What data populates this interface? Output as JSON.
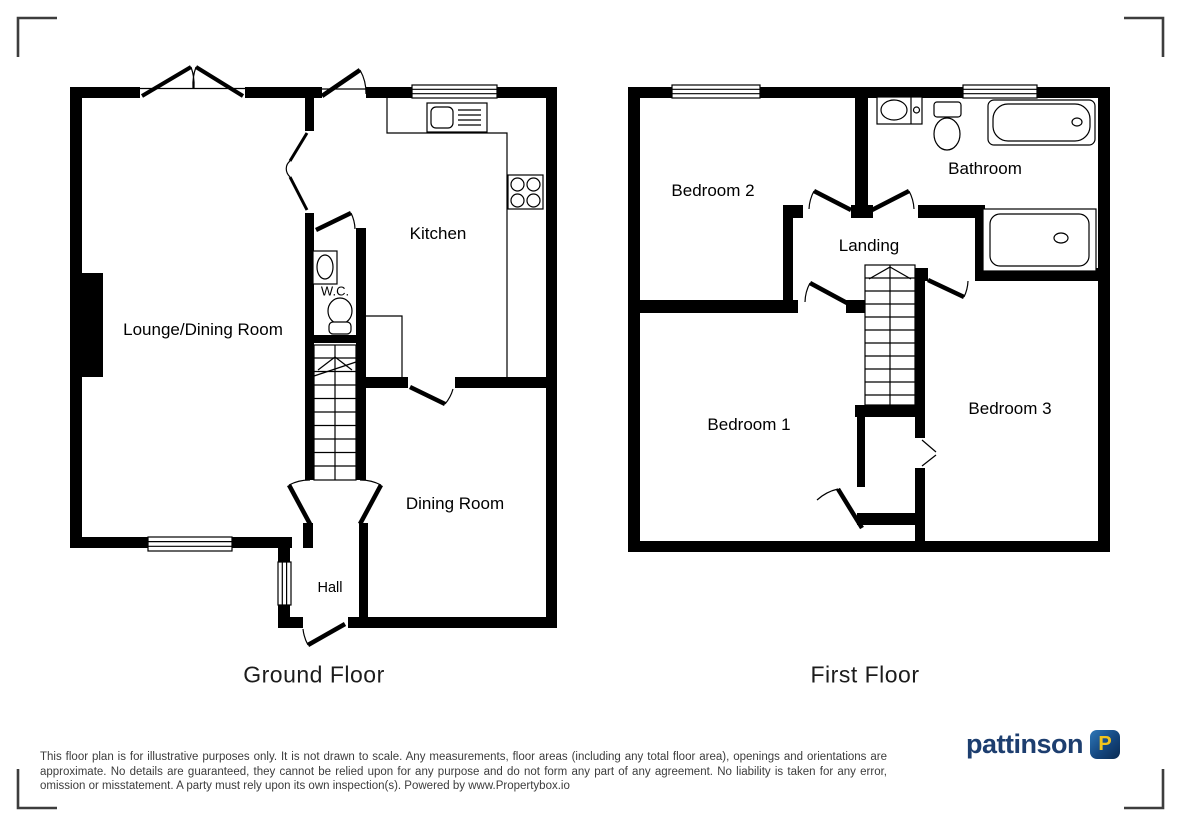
{
  "ground_floor": {
    "title": "Ground Floor",
    "rooms": {
      "lounge": "Lounge/Dining Room",
      "kitchen": "Kitchen",
      "wc": "W.C.",
      "dining": "Dining Room",
      "hall": "Hall"
    }
  },
  "first_floor": {
    "title": "First Floor",
    "rooms": {
      "bedroom2": "Bedroom 2",
      "bathroom": "Bathroom",
      "landing": "Landing",
      "bedroom1": "Bedroom 1",
      "bedroom3": "Bedroom 3"
    }
  },
  "footer": {
    "disclaimer": "This floor plan is for illustrative purposes only. It is not drawn to scale. Any measurements, floor areas (including any total floor area), openings and orientations are approximate. No details are guaranteed, they cannot be relied upon for any purpose and do not form any part of any agreement. No liability is taken for any error, omission or misstatement. A party must rely upon its own inspection(s). Powered by www.Propertybox.io",
    "logo": {
      "name": "pattinson",
      "badge_letter": "P"
    }
  },
  "icons": [
    "stairs-icon",
    "kitchen-sink-icon",
    "hob-icon",
    "wc-basin-icon",
    "wc-toilet-icon",
    "bathroom-basin-icon",
    "bathroom-toilet-icon",
    "bath-icon",
    "shower-icon",
    "window-icon",
    "door-swing-icon",
    "corner-crop-mark",
    "pattinson-logo-badge"
  ],
  "colors": {
    "wall": "#000000",
    "line": "#000000",
    "corner_mark": "#3d3d3d",
    "logo_text": "#1d3e6f",
    "logo_badge_gradient": [
      "#2e77b8",
      "#0a2a52"
    ],
    "logo_letter": "#f3c51c",
    "disclaimer_text": "#3c3c3c"
  }
}
